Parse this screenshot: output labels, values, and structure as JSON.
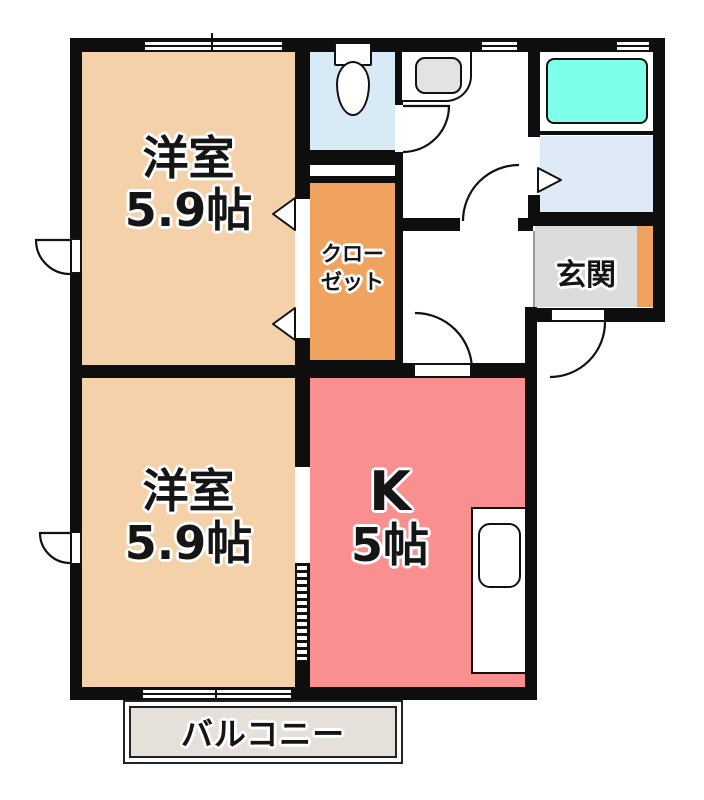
{
  "plan_title": "apartment-floor-plan",
  "rooms": {
    "bedroom_top": {
      "name": "洋室",
      "size": "5.9帖"
    },
    "bedroom_bottom": {
      "name": "洋室",
      "size": "5.9帖"
    },
    "kitchen": {
      "name": "K",
      "size": "5帖"
    },
    "closet": {
      "name_line1": "クロー",
      "name_line2": "ゼット"
    },
    "entrance": {
      "name": "玄関"
    },
    "balcony": {
      "name": "バルコニー"
    }
  },
  "fixtures": {
    "toilet": "toilet-with-tank",
    "wash_basin": "washroom-sink",
    "bathtub": "bathtub",
    "kitchen_sink": "kitchen-counter-with-sink"
  },
  "colors": {
    "wall": "#0E0E0E",
    "bedroom_fill": "#F4D1A9",
    "kitchen_fill": "#F9908F",
    "closet_fill": "#F0A25F",
    "toilet_fill": "#D9EAF7",
    "dressing_fill": "#DEEBF7",
    "bathtub_fill": "#7DFFE9",
    "entrance_fill": "#DCDCDC",
    "entrance_step_fill": "#F0A25F",
    "balcony_fill": "#E6E0DA"
  }
}
